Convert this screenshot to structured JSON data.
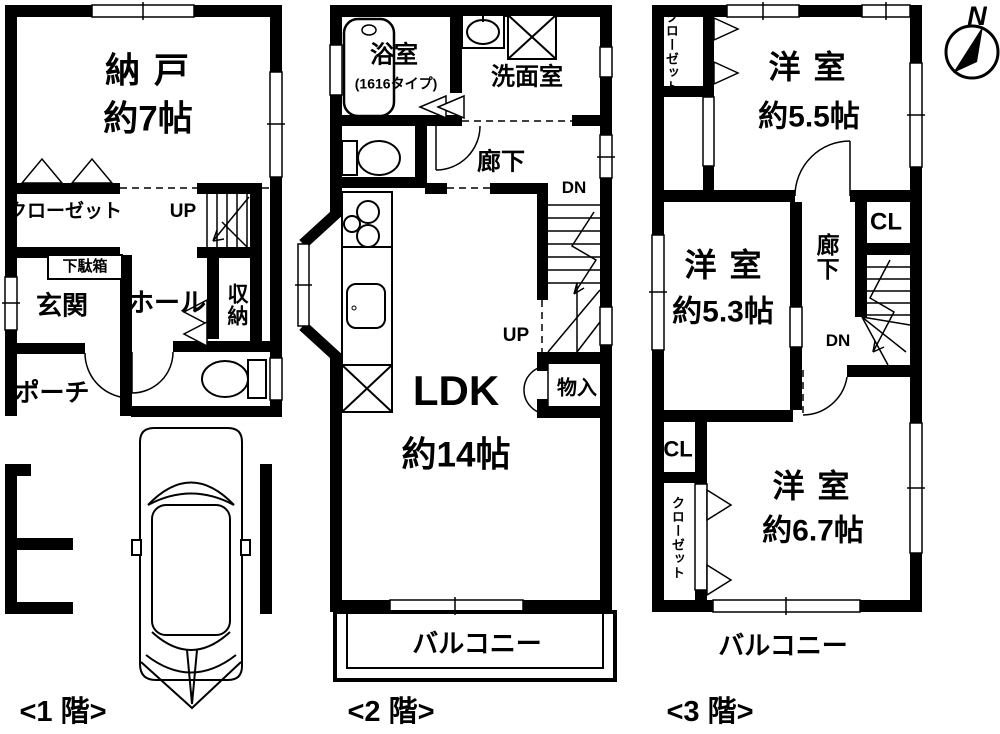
{
  "compass": {
    "north": "N"
  },
  "floor1": {
    "label": "<1 階>",
    "nando": "納 戸",
    "nando_size": "約7帖",
    "closet": "クローゼット",
    "up": "UP",
    "getabako": "下駄箱",
    "genkan": "玄関",
    "hall": "ホール",
    "shuno": "収納",
    "porch": "ポーチ"
  },
  "floor2": {
    "label": "<2 階>",
    "bath": "浴室",
    "bath_type": "(1616タイプ)",
    "washroom": "洗面室",
    "hallway": "廊下",
    "dn": "DN",
    "up": "UP",
    "ldk": "LDK",
    "ldk_size": "約14帖",
    "storage": "物入",
    "balcony": "バルコニー"
  },
  "floor3": {
    "label": "<3 階>",
    "closet_top": "クローゼット",
    "room1": "洋 室",
    "room1_size": "約5.5帖",
    "room2": "洋 室",
    "room2_size": "約5.3帖",
    "hallway": "廊下",
    "cl_top": "CL",
    "dn": "DN",
    "cl_mid": "CL",
    "closet_bottom": "クローゼット",
    "room3": "洋 室",
    "room3_size": "約6.7帖",
    "balcony": "バルコニー"
  }
}
